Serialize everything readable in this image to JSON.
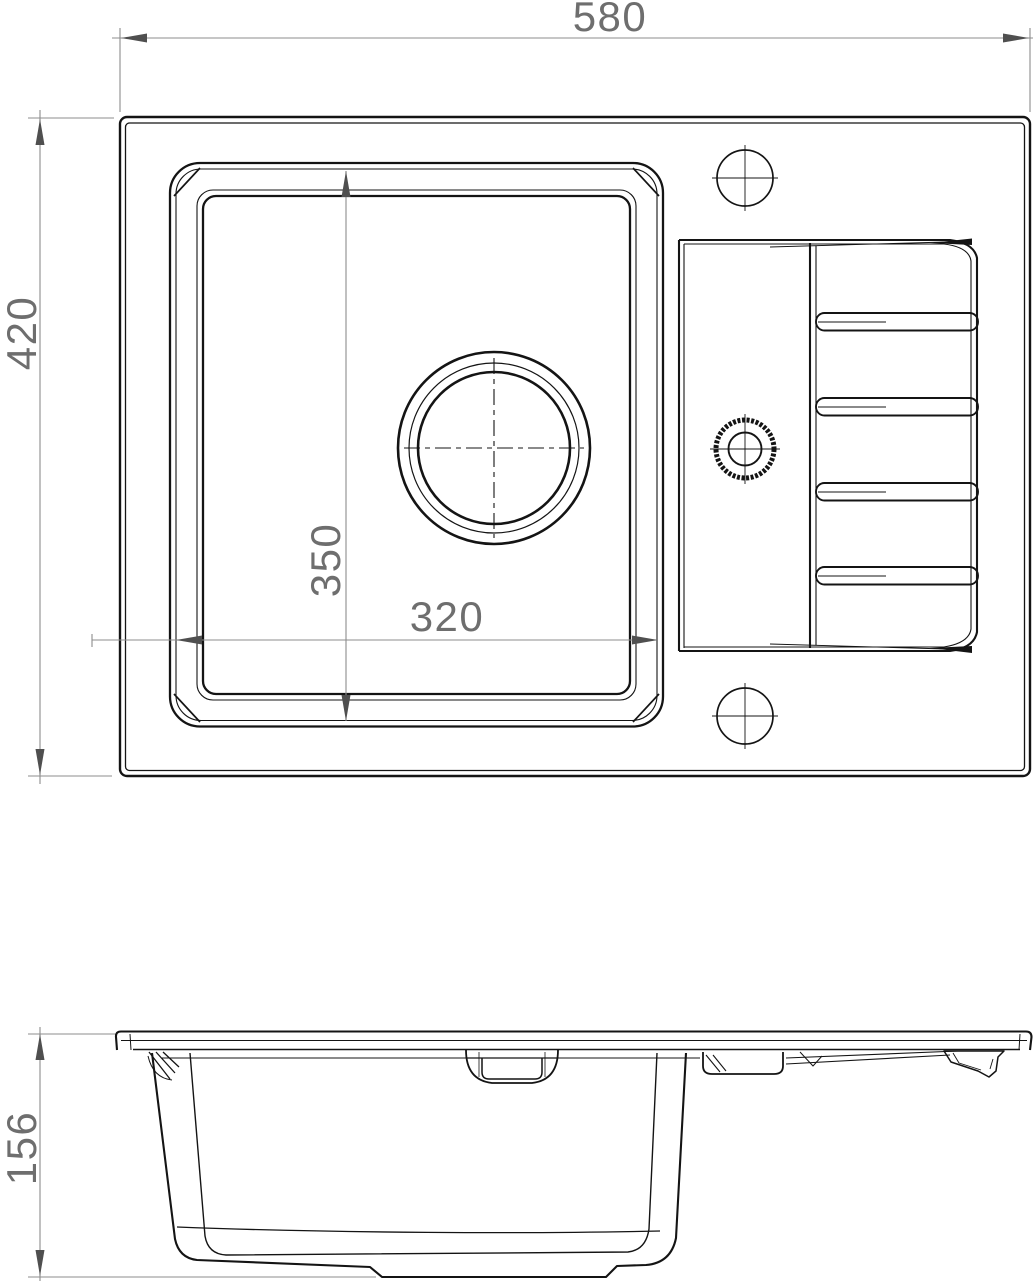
{
  "colors": {
    "background": "#ffffff",
    "outline": "#141414",
    "dimension_line": "#8c8c8c",
    "dimension_text": "#6e6e6e",
    "arrowhead": "#4f4f4f"
  },
  "dimensions": {
    "overall_width": {
      "value": "580",
      "orientation": "horizontal",
      "view": "top"
    },
    "overall_depth": {
      "value": "420",
      "orientation": "vertical",
      "view": "top"
    },
    "bowl_depth": {
      "value": "350",
      "orientation": "vertical",
      "view": "top"
    },
    "bowl_width": {
      "value": "320",
      "orientation": "horizontal",
      "view": "top"
    },
    "overall_height": {
      "value": "156",
      "orientation": "vertical",
      "view": "side"
    }
  }
}
